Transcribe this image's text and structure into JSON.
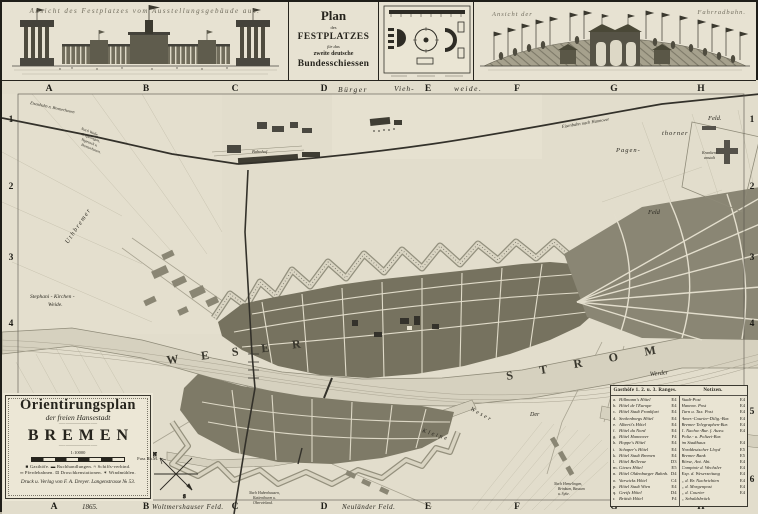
{
  "top": {
    "left_view_caption": "Ansicht des Festplatzes vom Ausstellungsgebäude aus.",
    "plan_box": {
      "line1": "Plan",
      "line2": "des",
      "line3": "FESTPLATZES",
      "line4": "für das",
      "line5": "zweite deutsche",
      "line6": "Bundesschiessen"
    },
    "right_view_caption_left": "Ansicht der",
    "right_view_caption_right": "Fahrradbahn."
  },
  "map": {
    "grid": {
      "cols": [
        "A",
        "B",
        "C",
        "D",
        "E",
        "F",
        "G",
        "H"
      ],
      "rows": [
        "1",
        "2",
        "3",
        "4",
        "5",
        "6"
      ]
    },
    "labels": {
      "weser": "W E S E R",
      "strom": "S T R O M",
      "kleine": "Kleine",
      "weser2": "Weser",
      "werder": "Werder",
      "der": "Der",
      "buerger": "Bürger",
      "vieh": "Vieh-",
      "weide": "weide.",
      "pagen": "Pagen-",
      "thorner": "thorner",
      "feld_ne": "Feld.",
      "feld_e": "Feld",
      "krankenanstalt1": "Kranken-",
      "krankenanstalt2": "anstalt",
      "uthbremer": "Uthbremer",
      "stephani1": "Stephani - Kirchen -",
      "stephani2": "Weide.",
      "bahnhof": "Bahnhof",
      "eisenbahn_hannover": "Eisenbahn nach Hannover",
      "eisenbahn_bremerhaven": "Eisenbahn n. Bremerhaven",
      "woltmershauser": "Woltmershauser  Feld.",
      "neulaender": "Neuländer  Feld.",
      "year": "1865.",
      "compass_n": "N",
      "compass_s": "S"
    },
    "notes": {
      "nw1": "Nach Walle,",
      "nw2": "Gröpelingen,",
      "nw3": "Vegesack u.",
      "nw4": "Bremerhaven.",
      "s1": "Nach Habenhausen,",
      "s2": "Kattenthurm u.",
      "s3": "Obervieland.",
      "se1": "Nach Hemelingen,",
      "se2": "Brinkum, Bassum",
      "se3": "u. Syke."
    }
  },
  "cartouche": {
    "title1": "Orientirungsplan",
    "title2": "der freien Hansestadt",
    "ornament": "—·—————·—",
    "title3": "BREMEN",
    "scale": "1:10000",
    "scale_unit": "Fuss Rh.M.",
    "legend_line1": "■ Gasthöfe.  ▬ Buchhandlungen.  ≈ Schiffs-verbind.",
    "legend_line2": "═ Pferdebahnen.  ⊡ Droschkenstationen.  ✶ Windmühlen.",
    "imprint": "Druck u. Verlag von F. A. Dreyer.  Langenstrasse № 53."
  },
  "directory": {
    "gasthoefe_header": "Gasthöfe 1. 2. u. 3. Ranges.",
    "notizen_header": "Notizen.",
    "gasthoefe": [
      {
        "k": "a.",
        "n": "Hillmann's Hôtel",
        "r": "E4"
      },
      {
        "k": "b.",
        "n": "Hôtel de l'Europe",
        "r": "E4"
      },
      {
        "k": "c.",
        "n": "Hôtel Stadt Frankfurt",
        "r": "E4"
      },
      {
        "k": "d.",
        "n": "Seekenborgs Hôtel",
        "r": "E4"
      },
      {
        "k": "e.",
        "n": "Alberti's Hôtel",
        "r": "E4"
      },
      {
        "k": "f.",
        "n": "Hôtel du Nord",
        "r": "E4"
      },
      {
        "k": "g.",
        "n": "Hôtel Hannover",
        "r": "F4"
      },
      {
        "k": "h.",
        "n": "Hoppe's Hôtel",
        "r": "E4"
      },
      {
        "k": "i.",
        "n": "Schaper's Hôtel",
        "r": "E4"
      },
      {
        "k": "k.",
        "n": "Hôtel Stadt Bremen",
        "r": "E4"
      },
      {
        "k": "l.",
        "n": "Hôtel Bellevue",
        "r": "D3"
      },
      {
        "k": "m.",
        "n": "Gieses Hôtel",
        "r": "E5"
      },
      {
        "k": "n.",
        "n": "Hôtel Oldenburger Bahnh.",
        "r": "D4"
      },
      {
        "k": "o.",
        "n": "Varwicks Hôtel",
        "r": "C4"
      },
      {
        "k": "p.",
        "n": "Hôtel Stadt Wien",
        "r": "E4"
      },
      {
        "k": "q.",
        "n": "Greifs Hôtel",
        "r": "D4"
      },
      {
        "k": "r.",
        "n": "British Hôtel",
        "r": "F4"
      }
    ],
    "notizen": [
      {
        "k": "",
        "n": "Stadt-Post",
        "r": "E4"
      },
      {
        "k": "",
        "n": "Hannov. Post",
        "r": "E4"
      },
      {
        "k": "",
        "n": "Turn u. Tax. Post",
        "r": "E4"
      },
      {
        "k": "",
        "n": "Amer.-Courier-Dilig.-Bur.",
        "r": "E4"
      },
      {
        "k": "",
        "n": "Bremer Telegraphen-Bur.",
        "r": "E4"
      },
      {
        "k": "",
        "n": "1. Nachw.-Bur. f. Ausw.",
        "r": "E4"
      },
      {
        "k": "",
        "n": "Poliz.- u. Polizei-Bur.",
        "r": ""
      },
      {
        "k": "",
        "n": "  im Stadthaus",
        "r": "E4"
      },
      {
        "k": "",
        "n": "Norddeutscher Lloyd",
        "r": "E5"
      },
      {
        "k": "",
        "n": "Bremer Bank",
        "r": "E5"
      },
      {
        "k": "",
        "n": "Börse, Ant. Abt.",
        "r": "E4"
      },
      {
        "k": "",
        "n": "Comptoir d. Wechsler",
        "r": "E4"
      },
      {
        "k": "",
        "n": "Exp. d. Weserzeitung",
        "r": "E4"
      },
      {
        "k": "",
        "n": "  „  d. Br. Nachrichten",
        "r": "E4"
      },
      {
        "k": "",
        "n": "  „  d. Morgenpost",
        "r": "E4"
      },
      {
        "k": "",
        "n": "  „  d. Courier",
        "r": "E4"
      },
      {
        "k": "",
        "n": "  „  Sebaldsbrück",
        "r": ""
      }
    ]
  }
}
